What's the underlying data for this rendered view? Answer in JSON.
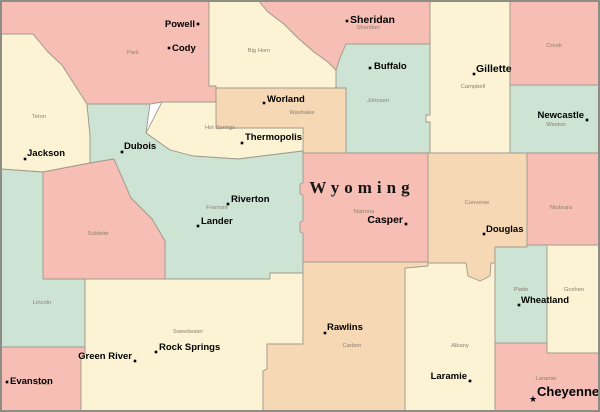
{
  "map": {
    "title": "Wyoming",
    "title_x": 362,
    "title_y": 193,
    "colors": {
      "pink": "#f6beb4",
      "cream": "#fbf3d3",
      "mint": "#cde3d3",
      "peach": "#f7d8b4",
      "county_border": "#a09a8e",
      "state_border": "#8d8d86",
      "county_label": "#8b8173",
      "city_label": "#000000"
    },
    "counties": [
      {
        "id": "teton",
        "label": "Teton",
        "color": "cream",
        "points": "0,34 33,34 48,52 62,65 78,90 87,104 90,135 90,163 43,172 0,169",
        "label_x": 39,
        "label_y": 118
      },
      {
        "id": "park",
        "label": "Park",
        "color": "pink",
        "points": "0,0 209,0 209,86 216,86 216,102 162,102 150,104 87,104 78,90 62,65 48,52 33,34 0,34",
        "label_x": 133,
        "label_y": 54
      },
      {
        "id": "bighorn",
        "label": "Big Horn",
        "color": "cream",
        "points": "209,0 258,0 268,12 284,24 298,38 314,52 328,62 336,70 336,88 216,88 216,86 209,86",
        "label_x": 259,
        "label_y": 52
      },
      {
        "id": "sheridan",
        "label": "Sheridan",
        "color": "pink",
        "points": "258,0 430,0 430,44 346,44 340,58 336,70 328,62 314,52 298,38 284,24 268,12",
        "label_x": 368,
        "label_y": 29
      },
      {
        "id": "johnson",
        "label": "Johnson",
        "color": "mint",
        "points": "346,44 430,44 430,153 346,153 346,88 336,88 336,70 340,58",
        "label_x": 378,
        "label_y": 102
      },
      {
        "id": "campbell",
        "label": "Campbell",
        "color": "cream",
        "points": "430,0 510,0 510,153 430,153 430,122 426,122 426,115 430,115",
        "label_x": 473,
        "label_y": 88
      },
      {
        "id": "crook",
        "label": "Crook",
        "color": "pink",
        "points": "510,0 600,0 600,85 510,85",
        "label_x": 554,
        "label_y": 47
      },
      {
        "id": "weston",
        "label": "Weston",
        "color": "mint",
        "points": "510,85 600,85 600,153 510,153",
        "label_x": 556,
        "label_y": 126
      },
      {
        "id": "washakie",
        "label": "Washakie",
        "color": "peach",
        "points": "216,88 346,88 346,153 303,153 303,128 216,128",
        "label_x": 302,
        "label_y": 114
      },
      {
        "id": "hotsprings",
        "label": "Hot Springs",
        "color": "cream",
        "points": "162,102 216,102 216,128 303,128 303,151 262,156 238,159 193,156 170,150 146,133",
        "label_x": 220,
        "label_y": 129
      },
      {
        "id": "fremont",
        "label": "Fremont",
        "color": "mint",
        "points": "87,104 150,104 146,133 170,150 193,156 238,159 262,156 303,151 303,273 270,273 270,279 165,279 165,241 152,219 131,198 114,159 90,163 90,135",
        "label_x": 217,
        "label_y": 209
      },
      {
        "id": "sublette",
        "label": "Sublette",
        "color": "pink",
        "points": "43,172 90,163 114,159 131,198 152,219 165,241 165,279 43,279",
        "label_x": 98,
        "label_y": 235
      },
      {
        "id": "lincoln",
        "label": "Lincoln",
        "color": "mint",
        "points": "0,169 43,172 43,279 85,279 85,347 0,347",
        "label_x": 42,
        "label_y": 304
      },
      {
        "id": "uinta",
        "label": "Uinta",
        "color": "pink",
        "points": "0,347 85,347 85,355 81,357 81,412 0,412",
        "label_x": 43,
        "label_y": 385
      },
      {
        "id": "sweetwater",
        "label": "Sweetwater",
        "color": "cream",
        "points": "85,279 270,279 270,273 303,273 303,344 267,344 267,369 263,371 263,412 81,412 81,357 85,355 85,347",
        "label_x": 188,
        "label_y": 333
      },
      {
        "id": "natrona",
        "label": "Natrona",
        "color": "pink",
        "points": "303,153 428,153 428,262 303,262 303,233 300,232 300,222 303,221 303,195 300,194 300,184 303,183",
        "label_x": 364,
        "label_y": 213
      },
      {
        "id": "albany",
        "label": "Albany",
        "color": "cream",
        "points": "405,266 428,263 495,263 495,412 405,412",
        "label_x": 460,
        "label_y": 347
      },
      {
        "id": "converse",
        "label": "Converse",
        "color": "peach",
        "points": "428,153 527,153 527,247 495,247 495,263 491,263 490,276 480,281 468,276 466,263 428,263",
        "label_x": 477,
        "label_y": 204
      },
      {
        "id": "niobrara",
        "label": "Niobrara",
        "color": "pink",
        "points": "527,153 600,153 600,245 527,245",
        "label_x": 561,
        "label_y": 209
      },
      {
        "id": "carbon",
        "label": "Carbon",
        "color": "peach",
        "points": "303,262 428,262 428,266 405,268 405,412 263,412 263,371 267,369 267,344 303,344",
        "label_x": 352,
        "label_y": 347
      },
      {
        "id": "platte",
        "label": "Platte",
        "color": "mint",
        "points": "495,247 527,247 527,245 547,245 547,343 495,343",
        "label_x": 521,
        "label_y": 291
      },
      {
        "id": "goshen",
        "label": "Goshen",
        "color": "cream",
        "points": "547,245 600,245 600,353 547,353",
        "label_x": 574,
        "label_y": 291
      },
      {
        "id": "laramie",
        "label": "Laramie",
        "color": "pink",
        "points": "495,343 547,343 547,353 600,353 600,412 495,412",
        "label_x": 546,
        "label_y": 380
      }
    ],
    "cities": [
      {
        "name": "Powell",
        "dot_x": 198,
        "dot_y": 24,
        "text_x": 195,
        "text_y": 27,
        "anchor": "end",
        "size": "m",
        "marker": "dot"
      },
      {
        "name": "Cody",
        "dot_x": 169,
        "dot_y": 48,
        "text_x": 172,
        "text_y": 51,
        "anchor": "start",
        "size": "m",
        "marker": "dot"
      },
      {
        "name": "Sheridan",
        "dot_x": 347,
        "dot_y": 21,
        "text_x": 350,
        "text_y": 23,
        "anchor": "start",
        "size": "l",
        "marker": "dot"
      },
      {
        "name": "Buffalo",
        "dot_x": 370,
        "dot_y": 68,
        "text_x": 374,
        "text_y": 69,
        "anchor": "start",
        "size": "m",
        "marker": "dot"
      },
      {
        "name": "Gillette",
        "dot_x": 474,
        "dot_y": 74,
        "text_x": 476,
        "text_y": 72,
        "anchor": "start",
        "size": "l",
        "marker": "dot"
      },
      {
        "name": "Newcastle",
        "dot_x": 587,
        "dot_y": 120,
        "text_x": 584,
        "text_y": 118,
        "anchor": "end",
        "size": "m",
        "marker": "dot"
      },
      {
        "name": "Worland",
        "dot_x": 264,
        "dot_y": 103,
        "text_x": 267,
        "text_y": 102,
        "anchor": "start",
        "size": "m",
        "marker": "dot"
      },
      {
        "name": "Thermopolis",
        "dot_x": 242,
        "dot_y": 143,
        "text_x": 245,
        "text_y": 140,
        "anchor": "start",
        "size": "m",
        "marker": "dot"
      },
      {
        "name": "Dubois",
        "dot_x": 122,
        "dot_y": 152,
        "text_x": 124,
        "text_y": 149,
        "anchor": "start",
        "size": "m",
        "marker": "dot"
      },
      {
        "name": "Jackson",
        "dot_x": 25,
        "dot_y": 159,
        "text_x": 27,
        "text_y": 156,
        "anchor": "start",
        "size": "m",
        "marker": "dot"
      },
      {
        "name": "Riverton",
        "dot_x": 228,
        "dot_y": 204,
        "text_x": 231,
        "text_y": 202,
        "anchor": "start",
        "size": "m",
        "marker": "dot"
      },
      {
        "name": "Lander",
        "dot_x": 198,
        "dot_y": 226,
        "text_x": 201,
        "text_y": 224,
        "anchor": "start",
        "size": "m",
        "marker": "dot"
      },
      {
        "name": "Casper",
        "dot_x": 406,
        "dot_y": 224,
        "text_x": 403,
        "text_y": 223,
        "anchor": "end",
        "size": "l",
        "marker": "dot"
      },
      {
        "name": "Douglas",
        "dot_x": 484,
        "dot_y": 234,
        "text_x": 486,
        "text_y": 232,
        "anchor": "start",
        "size": "m",
        "marker": "dot"
      },
      {
        "name": "Wheatland",
        "dot_x": 519,
        "dot_y": 305,
        "text_x": 521,
        "text_y": 303,
        "anchor": "start",
        "size": "m",
        "marker": "dot"
      },
      {
        "name": "Rawlins",
        "dot_x": 325,
        "dot_y": 333,
        "text_x": 327,
        "text_y": 330,
        "anchor": "start",
        "size": "m",
        "marker": "dot"
      },
      {
        "name": "Rock Springs",
        "dot_x": 156,
        "dot_y": 352,
        "text_x": 159,
        "text_y": 350,
        "anchor": "start",
        "size": "m",
        "marker": "dot"
      },
      {
        "name": "Green River",
        "dot_x": 135,
        "dot_y": 361,
        "text_x": 132,
        "text_y": 359,
        "anchor": "end",
        "size": "m",
        "marker": "dot"
      },
      {
        "name": "Evanston",
        "dot_x": 7,
        "dot_y": 382,
        "text_x": 10,
        "text_y": 384,
        "anchor": "start",
        "size": "m",
        "marker": "dot"
      },
      {
        "name": "Laramie",
        "dot_x": 470,
        "dot_y": 381,
        "text_x": 467,
        "text_y": 379,
        "anchor": "end",
        "size": "m",
        "marker": "dot"
      },
      {
        "name": "Cheyenne",
        "dot_x": 533,
        "dot_y": 399,
        "text_x": 537,
        "text_y": 396,
        "anchor": "start",
        "size": "xl",
        "marker": "star"
      }
    ]
  }
}
